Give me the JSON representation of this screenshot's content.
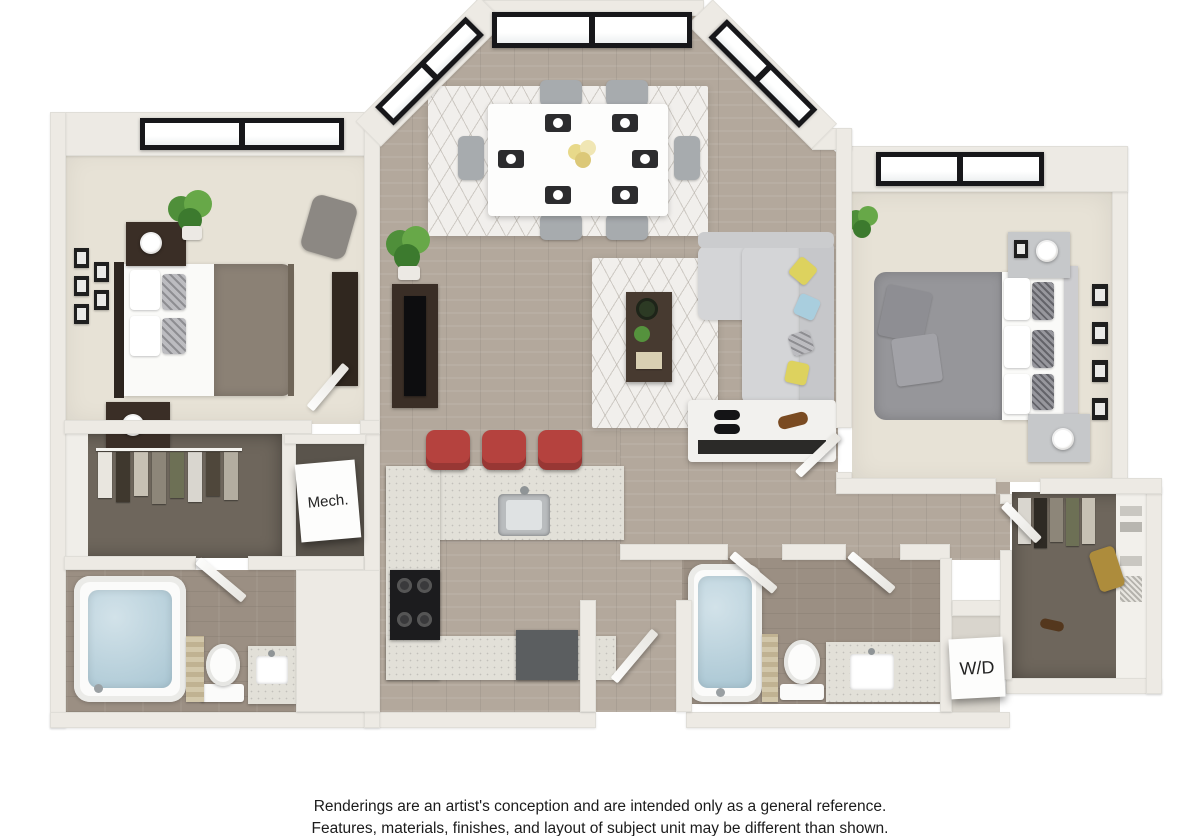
{
  "canvas": {
    "width": 1200,
    "height": 836,
    "background": "#ffffff"
  },
  "floorplan": {
    "labels": {
      "mech": "Mech.",
      "washer_dryer": "W/D"
    },
    "palette": {
      "wall": "#edeae4",
      "wood_floor": "#b3a89c",
      "carpet": "#e7e2d6",
      "bath_floor": "#9b8f83",
      "closet_floor": "#6e665c",
      "window_frame": "#17171a",
      "counter": "#e2e0d8",
      "stool_red": "#b5423e",
      "sofa_gray": "#d4d5d7",
      "duvet_taupe": "#8b8175",
      "duvet_gray": "#96969a",
      "dark_wood": "#3a2e26",
      "tub_water": "#a9c6d3",
      "pillow_yellow": "#ddd25e",
      "pillow_blue": "#a9cede",
      "plant_green": "#55923d",
      "bag_gold": "#ad8c3c"
    }
  },
  "disclaimer": {
    "line1": "Renderings are an artist's conception and are intended only as a general reference.",
    "line2": "Features, materials, finishes, and layout of subject unit may be different than shown."
  }
}
